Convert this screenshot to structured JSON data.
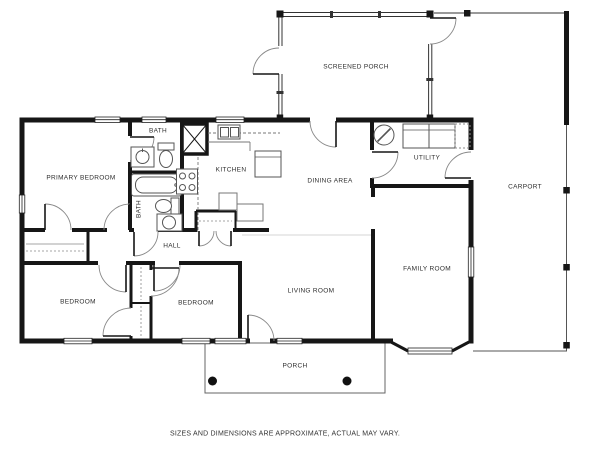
{
  "plan": {
    "rooms": {
      "screened_porch": "SCREENED PORCH",
      "primary_bedroom": "PRIMARY BEDROOM",
      "bath_top": "BATH",
      "bath_lower": "BATH",
      "kitchen": "KITCHEN",
      "dining_area": "DINING AREA",
      "utility": "UTILITY",
      "carport": "CARPORT",
      "hall": "HALL",
      "bedroom_left": "BEDROOM",
      "bedroom_right": "BEDROOM",
      "living_room": "LIVING ROOM",
      "family_room": "FAMILY ROOM",
      "porch": "PORCH"
    },
    "colors": {
      "wall": "#161616",
      "label": "#2e2e2e"
    }
  },
  "footer": {
    "disclaimer": "SIZES AND DIMENSIONS ARE APPROXIMATE, ACTUAL MAY VARY."
  }
}
